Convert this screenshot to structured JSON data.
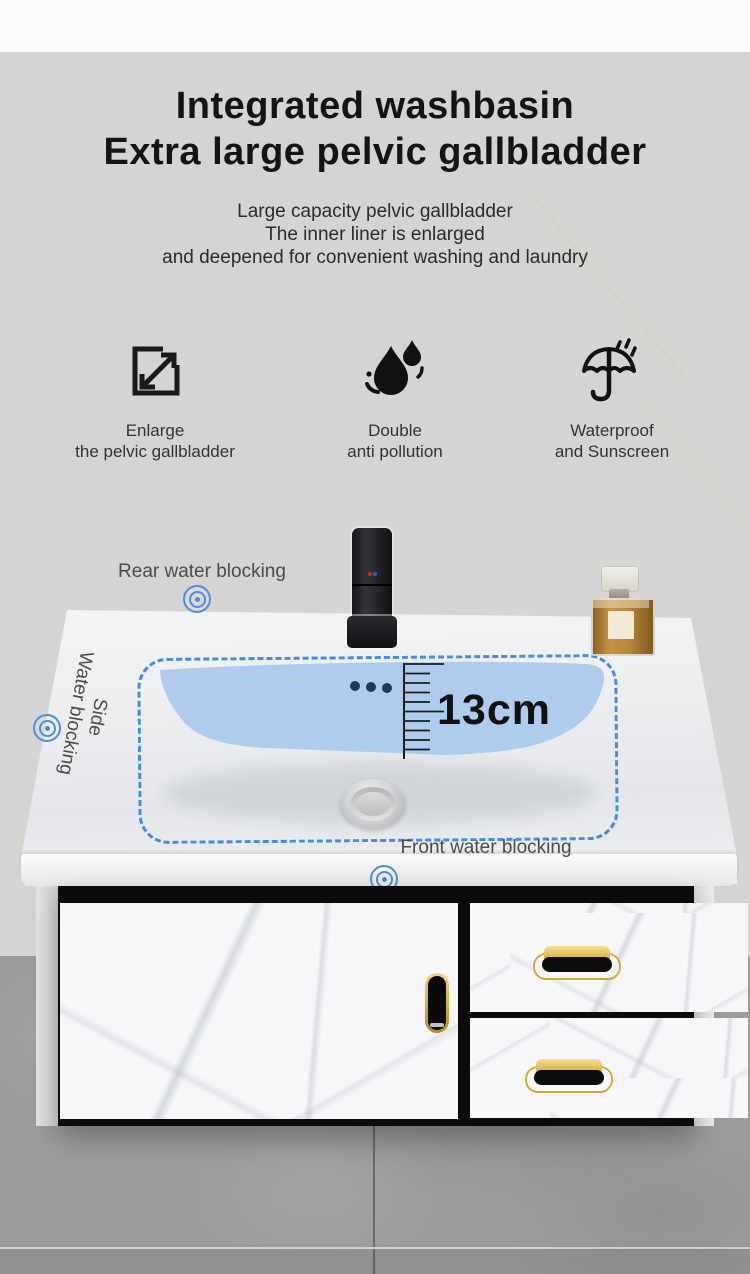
{
  "header": {
    "title_line1": "Integrated washbasin",
    "title_line2": "Extra large pelvic gallbladder",
    "subtitle_line1": "Large capacity pelvic gallbladder",
    "subtitle_line2": "The inner liner is enlarged",
    "subtitle_line3": "and deepened for convenient washing and laundry"
  },
  "features": [
    {
      "icon": "expand-icon",
      "label_line1": "Enlarge",
      "label_line2": "the pelvic gallbladder"
    },
    {
      "icon": "water-drops-icon",
      "label_line1": "Double",
      "label_line2": "anti pollution"
    },
    {
      "icon": "umbrella-icon",
      "label_line1": "Waterproof",
      "label_line2": "and Sunscreen"
    }
  ],
  "scene": {
    "labels": {
      "rear": "Rear water blocking",
      "side_line1": "Side",
      "side_line2": "Water blocking",
      "front": "Front water blocking",
      "depth": "13cm"
    },
    "colors": {
      "highlight_blue": "#accaec",
      "dashed_border": "#3f8de4",
      "overflow_dot": "#1d3a57",
      "gold_handle": "#d2ab38",
      "faucet_black": "#1a1a1d"
    }
  }
}
